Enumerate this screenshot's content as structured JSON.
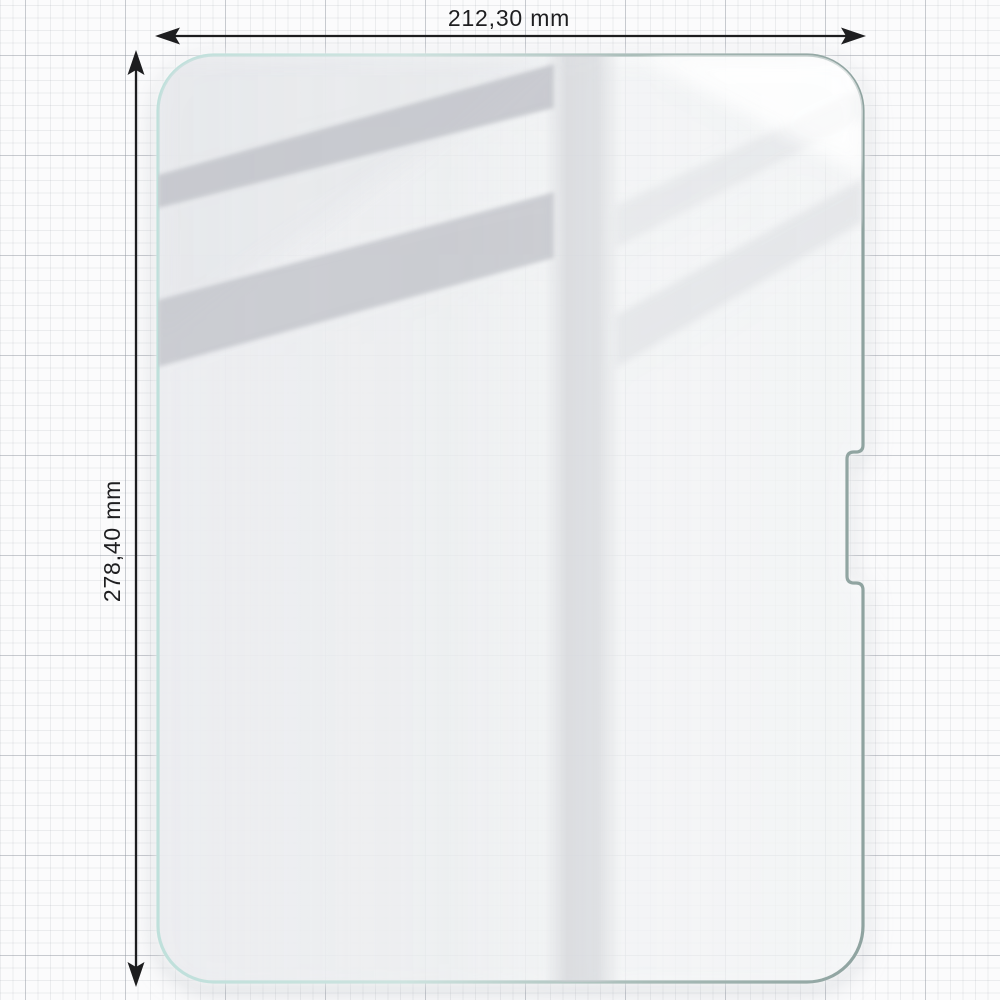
{
  "figure": {
    "kind": "product-dimension-diagram",
    "subject": "tablet tempered-glass screen protector on graph paper",
    "dimensions": {
      "width": {
        "label": "212,30 mm",
        "orientation": "horizontal"
      },
      "height": {
        "label": "278,40 mm",
        "orientation": "vertical"
      }
    },
    "features": {
      "right_edge_notch": "rectangular cutout on right edge",
      "reflections": "diagonal window-frame glare streaks on glass"
    }
  },
  "icons": {
    "width_arrow": "double-headed-horizontal-dimension-arrow",
    "height_arrow": "double-headed-vertical-dimension-arrow"
  },
  "colors": {
    "paper_bg": "#fbfbfc",
    "grid_minor": "#e8e9ec",
    "grid_major": "#c6c9cf",
    "glass_edge_teal": "#bfe0db",
    "glass_edge_gray": "#8fa3a0",
    "glass_fill": "#eceef0",
    "reflection_gray": "#c2c4ca",
    "dimension_line": "#1d1d1f"
  }
}
